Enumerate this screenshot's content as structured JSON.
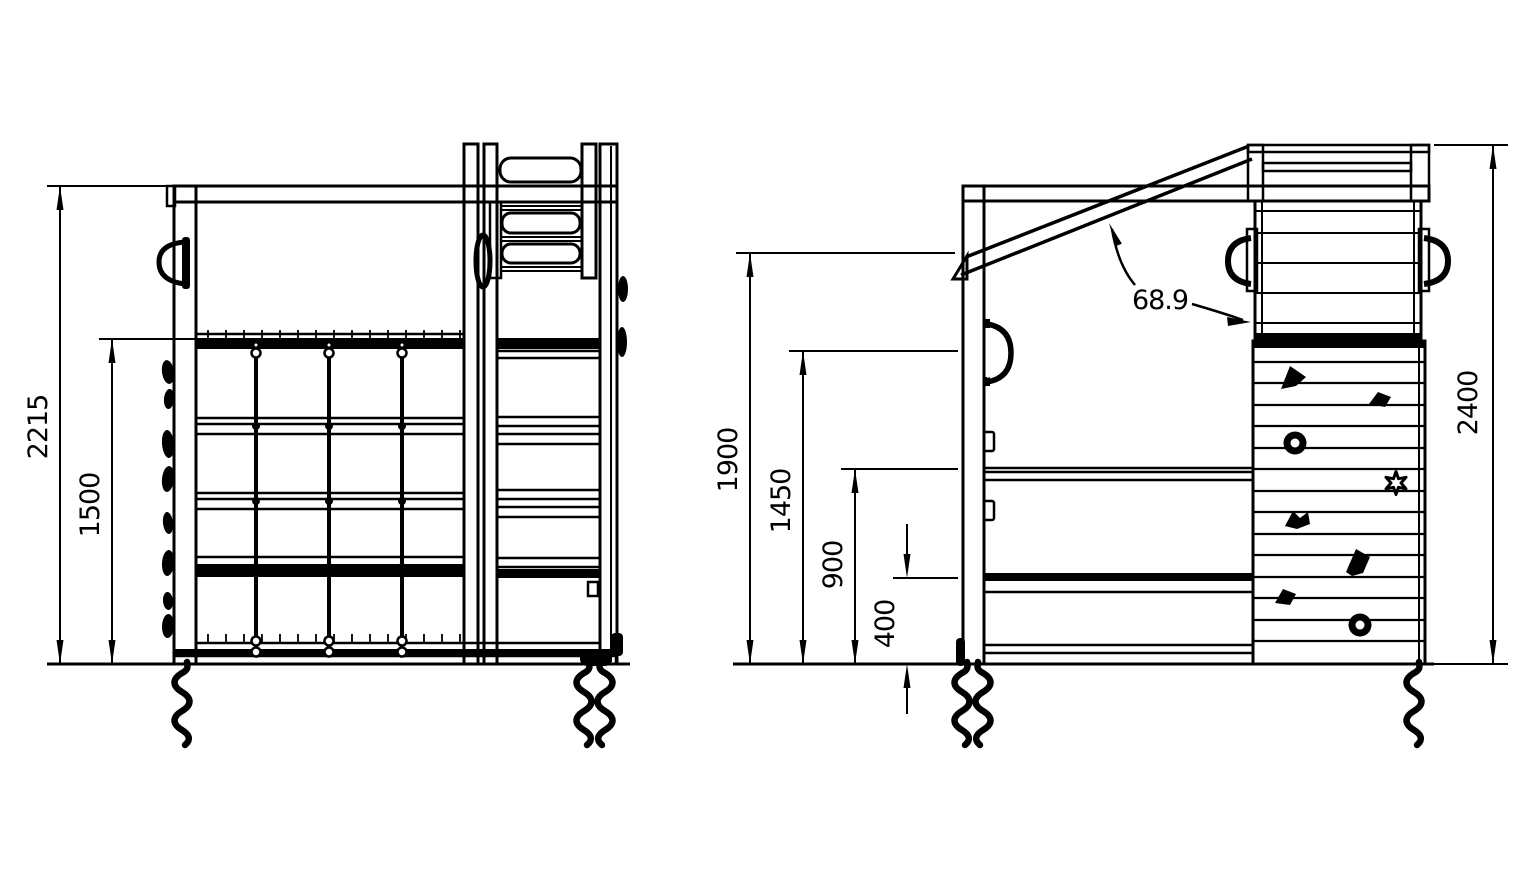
{
  "colors": {
    "line": "#000000",
    "background": "#ffffff"
  },
  "views": {
    "side": {
      "title": "side view of climbing frame",
      "dims": {
        "total_height": "2215",
        "net_top_height": "1500"
      }
    },
    "front": {
      "title": "front view of climbing frame",
      "dims": {
        "brace_height": "1900",
        "handle_height": "1450",
        "rail_900": "900",
        "rail_400": "400",
        "brace_angle": "68.9",
        "overall_height": "2400"
      }
    }
  }
}
